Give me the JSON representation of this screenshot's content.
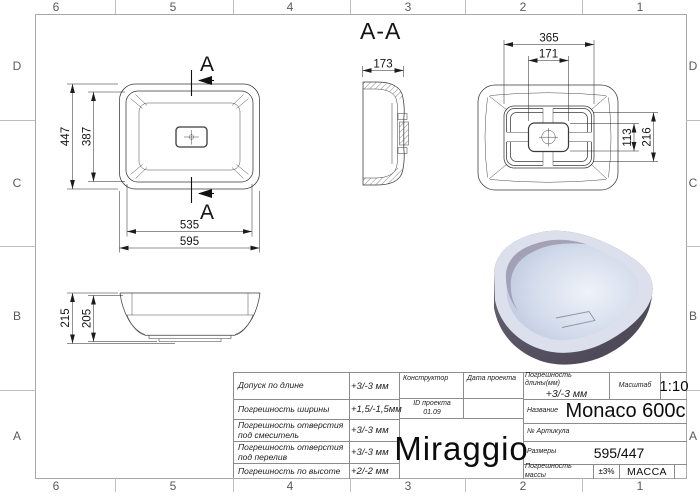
{
  "frame": {
    "columns": [
      "6",
      "5",
      "4",
      "3",
      "2",
      "1"
    ],
    "rows": [
      "D",
      "C",
      "B",
      "A"
    ]
  },
  "views": {
    "section_label": "A-A",
    "section_marker": "A",
    "top_view": {
      "outer_width": "595",
      "inner_width": "535",
      "outer_depth": "447",
      "inner_depth": "387"
    },
    "section_view": {
      "width": "173"
    },
    "bottom_view": {
      "base_width": "365",
      "plate_width": "171",
      "plate_height": "113",
      "base_depth": "216"
    },
    "front_view": {
      "total_height": "215",
      "body_height": "205"
    }
  },
  "title_block": {
    "tolerances": [
      {
        "label": "Допуск по длине",
        "value": "+3/-3 мм"
      },
      {
        "label": "Погрешность ширины",
        "value": "+1,5/-1,5мм"
      },
      {
        "label": "Погрешность отверстия под смеситель",
        "value": "+3/-3 мм"
      },
      {
        "label": "Погрешность отверстия под перелив",
        "value": "+3/-3 мм"
      },
      {
        "label": "Погрешность по высоте",
        "value": "+2/-2 мм"
      }
    ],
    "designer_label": "Конструктор",
    "project_date_label": "Дата проекта",
    "project_id_label": "ID проекта",
    "project_id_value": "01.09",
    "logo": "Miraggio",
    "length_tolerance_label": "Погрешность длины(мм)",
    "length_tolerance_value": "+3/-3 мм",
    "scale_label": "Масштаб",
    "scale_value": "1:10",
    "name_label": "Название",
    "name_value": "Monaco 600c",
    "article_label": "№ Артикула",
    "size_label": "Размеры",
    "size_value": "595/447",
    "mass_tolerance_label": "Погрешность массы",
    "mass_tolerance_value": "±3%",
    "mass_label": "МАССА"
  }
}
